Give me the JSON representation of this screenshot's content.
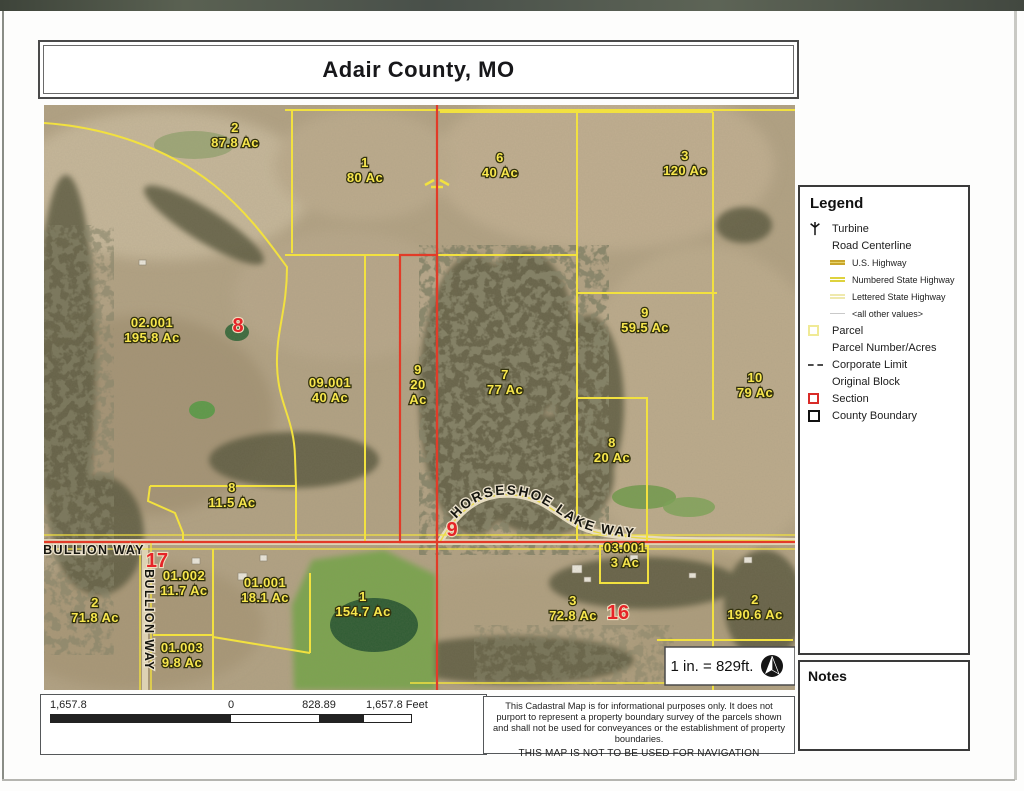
{
  "title": "Adair County, MO",
  "colors": {
    "parcel_yellow": "#f2e13f",
    "section_red": "#e23b28",
    "county_black": "#111111",
    "road_label_black": "#15150f",
    "scan_band": "#4e5548"
  },
  "map": {
    "scale_note": "1 in. = 829ft.",
    "road_labels": {
      "bullion_horizontal": "BULLION WAY",
      "bullion_vertical": "BULLION WAY",
      "horseshoe": "HORSESHOE LAKE WAY"
    },
    "parcel_labels": [
      {
        "lines": [
          "2",
          "87.8 Ac"
        ],
        "x": 191,
        "y": 27
      },
      {
        "lines": [
          "1",
          "80 Ac"
        ],
        "x": 321,
        "y": 62
      },
      {
        "lines": [
          "6",
          "40 Ac"
        ],
        "x": 456,
        "y": 57
      },
      {
        "lines": [
          "3",
          "120 Ac"
        ],
        "x": 641,
        "y": 55
      },
      {
        "lines": [
          "02.001",
          "195.8 Ac"
        ],
        "x": 108,
        "y": 222
      },
      {
        "lines": [
          "09.001",
          "40 Ac"
        ],
        "x": 286,
        "y": 282
      },
      {
        "lines": [
          "9",
          "20",
          "Ac"
        ],
        "x": 374,
        "y": 269
      },
      {
        "lines": [
          "7",
          "77 Ac"
        ],
        "x": 461,
        "y": 274
      },
      {
        "lines": [
          "9",
          "59.5 Ac"
        ],
        "x": 601,
        "y": 212
      },
      {
        "lines": [
          "8",
          "20 Ac"
        ],
        "x": 568,
        "y": 342
      },
      {
        "lines": [
          "10",
          "79 Ac"
        ],
        "x": 711,
        "y": 277
      },
      {
        "lines": [
          "8",
          "11.5 Ac"
        ],
        "x": 188,
        "y": 387
      },
      {
        "lines": [
          "01.002",
          "11.7 Ac"
        ],
        "x": 140,
        "y": 475
      },
      {
        "lines": [
          "01.001",
          "18.1 Ac"
        ],
        "x": 221,
        "y": 482
      },
      {
        "lines": [
          "01.003",
          "9.8 Ac"
        ],
        "x": 138,
        "y": 547
      },
      {
        "lines": [
          "2",
          "71.8 Ac"
        ],
        "x": 51,
        "y": 502
      },
      {
        "lines": [
          "1",
          "154.7 Ac"
        ],
        "x": 319,
        "y": 496
      },
      {
        "lines": [
          "3",
          "72.8 Ac"
        ],
        "x": 529,
        "y": 500
      },
      {
        "lines": [
          "03.001",
          "3 Ac"
        ],
        "x": 581,
        "y": 447
      },
      {
        "lines": [
          "2",
          "190.6 Ac"
        ],
        "x": 711,
        "y": 499
      }
    ],
    "section_numbers": [
      {
        "text": "8",
        "x": 194,
        "y": 227
      },
      {
        "text": "17",
        "x": 113,
        "y": 462
      },
      {
        "text": "9",
        "x": 408,
        "y": 431
      },
      {
        "text": "16",
        "x": 574,
        "y": 514
      }
    ]
  },
  "legend": {
    "heading": "Legend",
    "items": [
      {
        "label": "Turbine",
        "icon": "turbine",
        "level": "main"
      },
      {
        "label": "Road Centerline",
        "icon": "none",
        "level": "main"
      },
      {
        "label": "U.S. Highway",
        "icon": "us-highway",
        "level": "sub"
      },
      {
        "label": "Numbered State Highway",
        "icon": "numbered-state-highway",
        "level": "sub"
      },
      {
        "label": "Lettered State Highway",
        "icon": "lettered-state-highway",
        "level": "sub"
      },
      {
        "label": "<all other values>",
        "icon": "other-values",
        "level": "sub"
      },
      {
        "label": "Parcel",
        "icon": "parcel",
        "level": "main"
      },
      {
        "label": "Parcel Number/Acres",
        "icon": "none",
        "level": "main"
      },
      {
        "label": "Corporate Limit",
        "icon": "corporate-limit",
        "level": "main"
      },
      {
        "label": "Original Block",
        "icon": "none",
        "level": "main"
      },
      {
        "label": "Section",
        "icon": "section",
        "level": "main"
      },
      {
        "label": "County Boundary",
        "icon": "county-boundary",
        "level": "main"
      }
    ]
  },
  "notes": {
    "heading": "Notes"
  },
  "scalebar": {
    "labels": [
      "1,657.8",
      "0",
      "828.89",
      "1,657.8 Feet"
    ]
  },
  "disclaimer": {
    "body": "This Cadastral Map is for informational purposes only.  It does not purport to represent a property boundary survey of the parcels shown and shall not be used for conveyances or the establishment of property boundaries.",
    "warning": "THIS MAP IS NOT TO BE USED FOR NAVIGATION"
  }
}
